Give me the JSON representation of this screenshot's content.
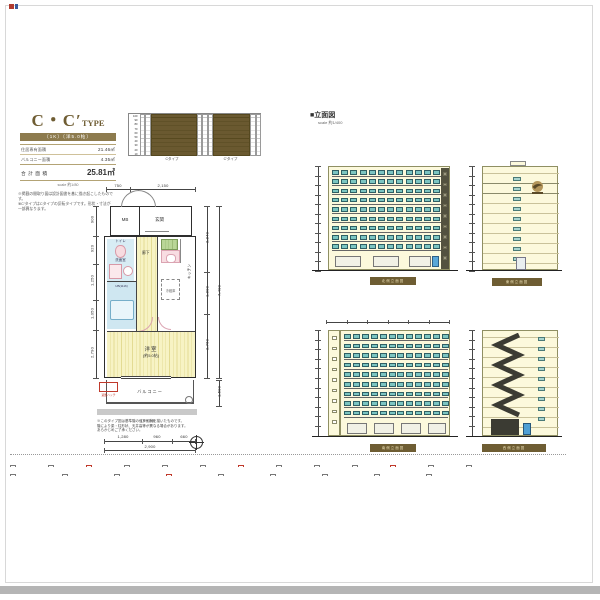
{
  "colors": {
    "brand_gold": "#8d7b4e",
    "key_plan_highlight": "#6a5930",
    "wet_area_blue": "#d8ecf4",
    "floor_yellow": "#f7f3c4",
    "window_teal": "#7cc5c1",
    "facade_cream": "#fcf9dc"
  },
  "title_block": {
    "title_main": "C・C′",
    "title_suffix": "TYPE",
    "band_text": "〔1K〕〔洋5.0帖〕",
    "specs": [
      {
        "label": "住居専有面積",
        "value": "21.46㎡"
      },
      {
        "label": "バルコニー面積",
        "value": "4.35㎡"
      }
    ],
    "total_label": "合 計 面 積",
    "total_value": "25.81㎡",
    "scale_note": "scale 約1/80",
    "disclaimer": [
      "※掲載の間取り図は設計図書を基に描き起こしたものです。",
      "※C′タイプはCタイプの反転タイプです。形状・寸法が",
      "一部異なります。"
    ]
  },
  "key_plan": {
    "floors": [
      "10F",
      "9F",
      "8F",
      "7F",
      "6F",
      "5F",
      "4F",
      "3F",
      "2F",
      "1F"
    ],
    "caption_left": "Cタイプ",
    "caption_right": "C′タイプ"
  },
  "elevation_section": {
    "title": "■立面図",
    "scale": "scale 約1/400",
    "elevations": [
      {
        "caption": "北側立面図"
      },
      {
        "caption": "東側立面図"
      },
      {
        "caption": "南側立面図"
      },
      {
        "caption": "西側立面図"
      }
    ]
  },
  "floor_plan": {
    "rooms": {
      "mb": "MB",
      "entrance": "玄関",
      "toilet": "トイレ",
      "sanitary": "洗面室",
      "bath": "UB(1116)",
      "hall": "廊下",
      "kitchen": "キッチン",
      "fridge": "冷蔵庫",
      "room": "洋室",
      "room_size": "(約5.0帖)",
      "balcony": "バルコニー",
      "hatch": "避難ハッチ",
      "rail": "ガラス手摺"
    },
    "dims": {
      "top": [
        "750",
        "2,150"
      ],
      "left": [
        "900",
        "920",
        "1,250",
        "1,050",
        "2,790"
      ],
      "right_inner": [
        "2,840",
        "1,800",
        "2,760"
      ],
      "right_outer": [
        "7,400",
        "1,500"
      ],
      "bottom": [
        "1,280",
        "960",
        "660"
      ],
      "bottom_total": "2,900"
    },
    "notes": [
      "※このタイプ図は基準階の住戸形状を描いたものです。",
      "階により梁・柱形状、天井高等が異なる場合があります。",
      "あらかじめご了承ください。"
    ]
  },
  "footer": {
    "rows": [
      {
        "items": 13,
        "red_at": [
          2,
          6,
          10
        ],
        "dots": "・・・・・・"
      },
      {
        "items": 9,
        "red_at": [
          3
        ],
        "dots": "・・・・・・・・・・"
      }
    ]
  }
}
